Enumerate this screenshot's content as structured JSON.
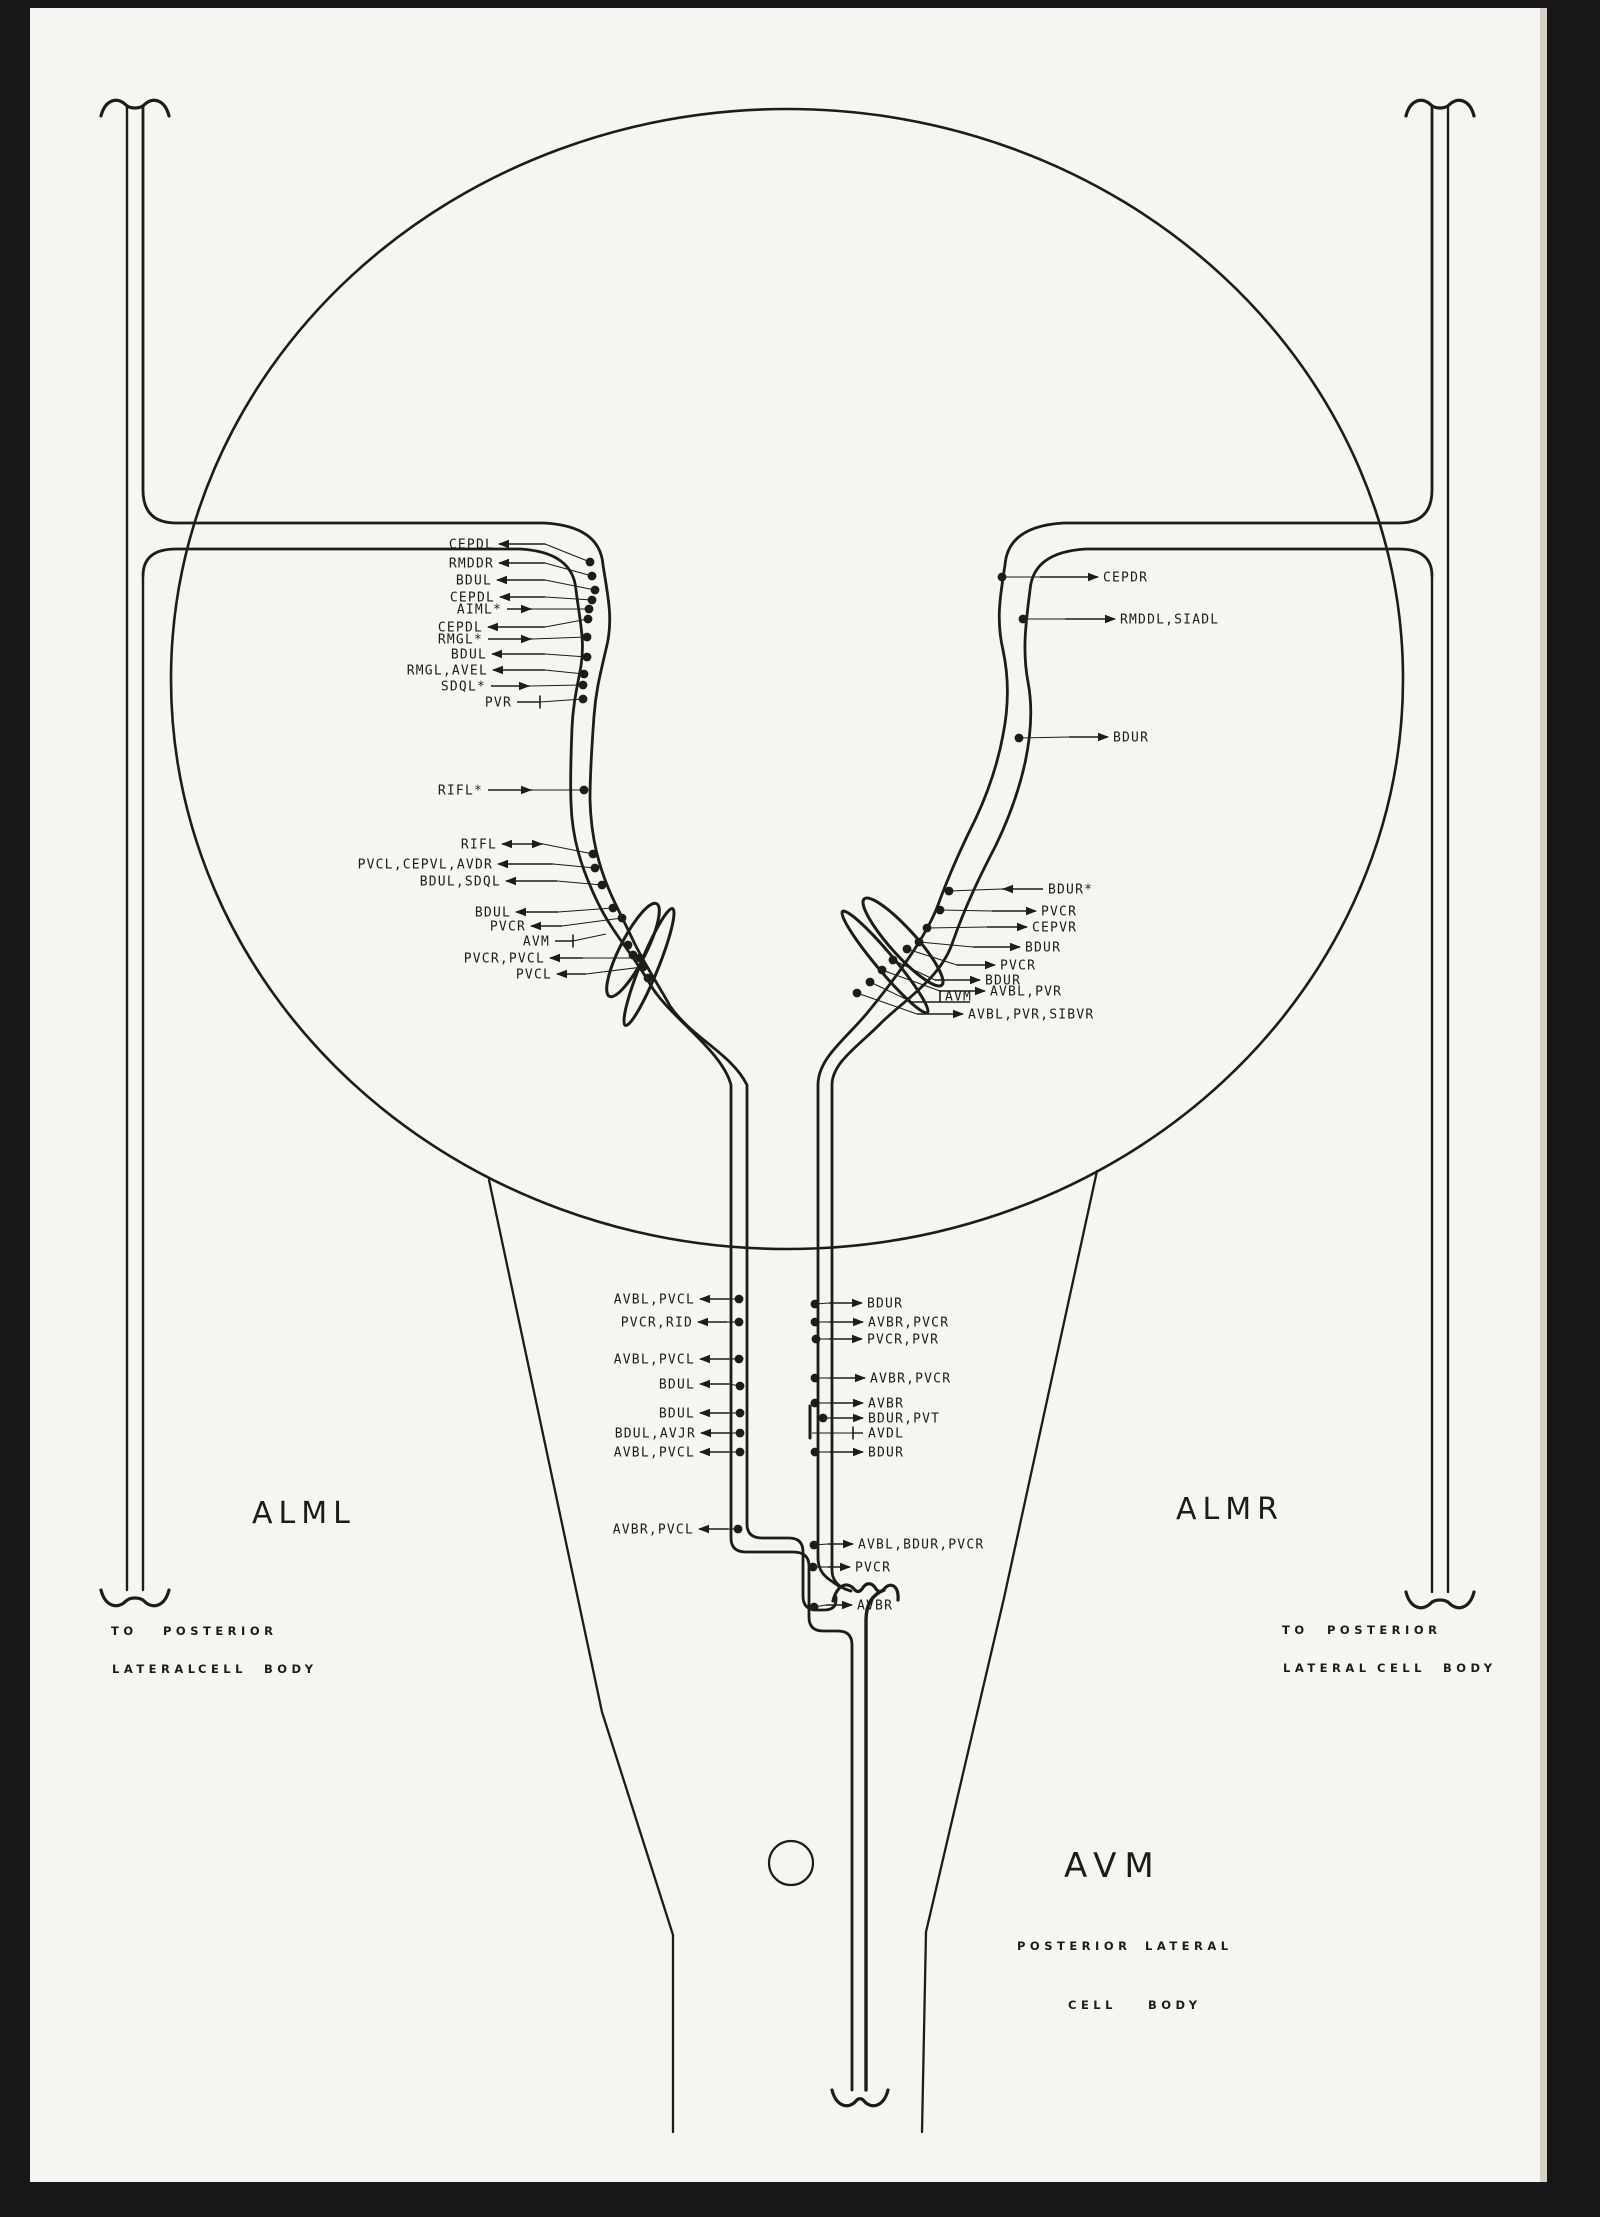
{
  "colors": {
    "ink": "#1e1c19",
    "paper": "#f6f5f1",
    "background": "#17171a",
    "paper_edge": "#d6d0c4"
  },
  "big_labels": {
    "alml": "ALML",
    "almr": "ALMR",
    "avm": "AVM"
  },
  "captions": [
    {
      "t": "TO",
      "x": 111,
      "y": 1635
    },
    {
      "t": "POSTERIOR",
      "x": 163,
      "y": 1635
    },
    {
      "t": "LATERAL",
      "x": 112,
      "y": 1673
    },
    {
      "t": "CELL",
      "x": 198,
      "y": 1673
    },
    {
      "t": "BODY",
      "x": 264,
      "y": 1673
    },
    {
      "t": "TO",
      "x": 1282,
      "y": 1634
    },
    {
      "t": "POSTERIOR",
      "x": 1327,
      "y": 1634
    },
    {
      "t": "LATERAL",
      "x": 1283,
      "y": 1672
    },
    {
      "t": "CELL",
      "x": 1377,
      "y": 1672
    },
    {
      "t": "BODY",
      "x": 1443,
      "y": 1672
    },
    {
      "t": "POSTERIOR",
      "x": 1017,
      "y": 1950
    },
    {
      "t": "LATERAL",
      "x": 1145,
      "y": 1950
    },
    {
      "t": "CELL",
      "x": 1068,
      "y": 2009
    },
    {
      "t": "BODY",
      "x": 1148,
      "y": 2009
    }
  ],
  "annotations": [
    {
      "g": "left-top",
      "t": "CEPDL",
      "s": "L",
      "x": 494,
      "y": 544,
      "hx": 545,
      "h": "T",
      "d": [
        590,
        562
      ]
    },
    {
      "g": "left-top",
      "t": "RMDDR",
      "s": "L",
      "x": 494,
      "y": 563,
      "hx": 545,
      "h": "T",
      "d": [
        592,
        576
      ]
    },
    {
      "g": "left-top",
      "t": "BDUL",
      "s": "L",
      "x": 492,
      "y": 580,
      "hx": 545,
      "h": "T",
      "d": [
        595,
        590
      ]
    },
    {
      "g": "left-top",
      "t": "CEPDL",
      "s": "L",
      "x": 495,
      "y": 597,
      "hx": 545,
      "h": "T",
      "d": [
        592,
        600
      ]
    },
    {
      "g": "left-top",
      "t": "AIML*",
      "s": "L",
      "x": 502,
      "y": 609,
      "hx": 532,
      "h": "F",
      "d": [
        589,
        609
      ]
    },
    {
      "g": "left-top",
      "t": "CEPDL",
      "s": "L",
      "x": 483,
      "y": 627,
      "hx": 545,
      "h": "T",
      "d": [
        588,
        619
      ]
    },
    {
      "g": "left-top",
      "t": "RMGL*",
      "s": "L",
      "x": 483,
      "y": 639,
      "hx": 532,
      "h": "F",
      "d": [
        587,
        637
      ]
    },
    {
      "g": "left-top",
      "t": "BDUL",
      "s": "L",
      "x": 487,
      "y": 654,
      "hx": 545,
      "h": "T",
      "d": [
        587,
        657
      ]
    },
    {
      "g": "left-top",
      "t": "RMGL,AVEL",
      "s": "L",
      "x": 488,
      "y": 670,
      "hx": 545,
      "h": "T",
      "d": [
        584,
        674
      ]
    },
    {
      "g": "left-top",
      "t": "SDQL*",
      "s": "L",
      "x": 486,
      "y": 686,
      "hx": 530,
      "h": "F",
      "d": [
        583,
        685
      ]
    },
    {
      "g": "left-top",
      "t": "PVR",
      "s": "L",
      "x": 512,
      "y": 702,
      "hx": 540,
      "h": "bar",
      "bx": 540,
      "d": [
        583,
        699
      ]
    },
    {
      "g": "left-ring",
      "t": "RIFL*",
      "s": "L",
      "x": 483,
      "y": 790,
      "hx": 532,
      "h": "F",
      "d": [
        584,
        790
      ]
    },
    {
      "g": "left-mid",
      "t": "RIFL",
      "s": "L",
      "x": 497,
      "y": 844,
      "hx": 543,
      "h": "TF",
      "d": [
        593,
        854
      ]
    },
    {
      "g": "left-mid",
      "t": "PVCL,CEPVL,AVDR",
      "s": "L",
      "x": 493,
      "y": 864,
      "hx": 553,
      "h": "T",
      "d": [
        595,
        868
      ]
    },
    {
      "g": "left-mid",
      "t": "BDUL,SDQL",
      "s": "L",
      "x": 501,
      "y": 881,
      "hx": 557,
      "h": "T",
      "d": [
        602,
        885
      ]
    },
    {
      "g": "left-mid",
      "t": "BDUL",
      "s": "L",
      "x": 511,
      "y": 912,
      "hx": 558,
      "h": "T",
      "d": [
        613,
        908
      ]
    },
    {
      "g": "left-mid",
      "t": "PVCR",
      "s": "L",
      "x": 526,
      "y": 926,
      "hx": 562,
      "h": "T",
      "d": [
        622,
        918
      ]
    },
    {
      "g": "left-mid",
      "t": "AVM",
      "s": "L",
      "x": 550,
      "y": 941,
      "hx": 573,
      "h": "bar",
      "bx": 573,
      "d": [
        606,
        934
      ],
      "nd": true
    },
    {
      "g": "left-mid",
      "t": "PVCR,PVCL",
      "s": "L",
      "x": 545,
      "y": 958,
      "hx": 583,
      "h": "T",
      "d": [
        640,
        958
      ]
    },
    {
      "g": "left-mid",
      "t": "PVCL",
      "s": "L",
      "x": 552,
      "y": 974,
      "hx": 586,
      "h": "T",
      "d": [
        643,
        967
      ]
    },
    {
      "g": "right-top",
      "t": "CEPDR",
      "s": "R",
      "x": 1103,
      "y": 577,
      "hx": 1040,
      "h": "T",
      "d": [
        1002,
        577
      ]
    },
    {
      "g": "right-top",
      "t": "RMDDL,SIADL",
      "s": "R",
      "x": 1120,
      "y": 619,
      "hx": 1065,
      "h": "T",
      "d": [
        1023,
        619
      ]
    },
    {
      "g": "right-top",
      "t": "BDUR",
      "s": "R",
      "x": 1113,
      "y": 737,
      "hx": 1069,
      "h": "T",
      "d": [
        1019,
        738
      ]
    },
    {
      "g": "right-mid",
      "t": "BDUR*",
      "s": "R",
      "x": 1048,
      "y": 889,
      "hx": 1002,
      "h": "F",
      "d": [
        949,
        891
      ]
    },
    {
      "g": "right-mid",
      "t": "PVCR",
      "s": "R",
      "x": 1041,
      "y": 911,
      "hx": 992,
      "h": "T",
      "d": [
        940,
        910
      ]
    },
    {
      "g": "right-mid",
      "t": "CEPVR",
      "s": "R",
      "x": 1032,
      "y": 927,
      "hx": 987,
      "h": "T",
      "d": [
        927,
        928
      ]
    },
    {
      "g": "right-mid",
      "t": "BDUR",
      "s": "R",
      "x": 1025,
      "y": 947,
      "hx": 973,
      "h": "T",
      "d": [
        919,
        942
      ]
    },
    {
      "g": "right-mid",
      "t": "PVCR",
      "s": "R",
      "x": 1000,
      "y": 965,
      "hx": 957,
      "h": "T",
      "d": [
        907,
        949
      ]
    },
    {
      "g": "right-mid",
      "t": "BDUR",
      "s": "R",
      "x": 985,
      "y": 980,
      "hx": 935,
      "h": "T",
      "d": [
        893,
        960
      ]
    },
    {
      "g": "right-mid",
      "t": "AVBL,PVR",
      "s": "R",
      "x": 990,
      "y": 991,
      "hx": 940,
      "h": "T",
      "d": [
        882,
        970
      ]
    },
    {
      "g": "right-mid",
      "t": "AVM",
      "s": "R",
      "x": 945,
      "y": 996,
      "hx": 912,
      "h": "barU",
      "bx": 940,
      "d": [
        870,
        982
      ]
    },
    {
      "g": "right-mid",
      "t": "AVBL,PVR,SIBVR",
      "s": "R",
      "x": 968,
      "y": 1014,
      "hx": 917,
      "h": "T",
      "d": [
        857,
        993
      ]
    },
    {
      "g": "center-left",
      "t": "AVBL,PVCL",
      "s": "L",
      "x": 695,
      "y": 1299,
      "hx": 729,
      "h": "T",
      "d": [
        739,
        1299
      ]
    },
    {
      "g": "center-left",
      "t": "PVCR,RID",
      "s": "L",
      "x": 693,
      "y": 1322,
      "hx": 727,
      "h": "T",
      "d": [
        739,
        1322
      ]
    },
    {
      "g": "center-left",
      "t": "AVBL,PVCL",
      "s": "L",
      "x": 695,
      "y": 1359,
      "hx": 729,
      "h": "T",
      "d": [
        739,
        1359
      ]
    },
    {
      "g": "center-left",
      "t": "BDUL",
      "s": "L",
      "x": 695,
      "y": 1384,
      "hx": 729,
      "h": "T",
      "d": [
        740,
        1386
      ]
    },
    {
      "g": "center-left",
      "t": "BDUL",
      "s": "L",
      "x": 695,
      "y": 1413,
      "hx": 729,
      "h": "T",
      "d": [
        740,
        1413
      ]
    },
    {
      "g": "center-left",
      "t": "BDUL,AVJR",
      "s": "L",
      "x": 696,
      "y": 1433,
      "hx": 730,
      "h": "T",
      "d": [
        740,
        1433
      ]
    },
    {
      "g": "center-left",
      "t": "AVBL,PVCL",
      "s": "L",
      "x": 695,
      "y": 1452,
      "hx": 729,
      "h": "T",
      "d": [
        740,
        1452
      ]
    },
    {
      "g": "center-left",
      "t": "AVBR,PVCL",
      "s": "L",
      "x": 694,
      "y": 1529,
      "hx": 728,
      "h": "T",
      "d": [
        738,
        1529
      ]
    },
    {
      "g": "center-right",
      "t": "BDUR",
      "s": "R",
      "x": 867,
      "y": 1303,
      "hx": 829,
      "h": "T",
      "d": [
        815,
        1304
      ]
    },
    {
      "g": "center-right",
      "t": "AVBR,PVCR",
      "s": "R",
      "x": 868,
      "y": 1322,
      "hx": 829,
      "h": "T",
      "d": [
        815,
        1322
      ]
    },
    {
      "g": "center-right",
      "t": "PVCR,PVR",
      "s": "R",
      "x": 867,
      "y": 1339,
      "hx": 829,
      "h": "T",
      "d": [
        816,
        1339
      ]
    },
    {
      "g": "center-right",
      "t": "AVBR,PVCR",
      "s": "R",
      "x": 870,
      "y": 1378,
      "hx": 830,
      "h": "T",
      "d": [
        815,
        1378
      ]
    },
    {
      "g": "center-right",
      "t": "AVBR",
      "s": "R",
      "x": 868,
      "y": 1403,
      "hx": 830,
      "h": "T",
      "d": [
        815,
        1403
      ]
    },
    {
      "g": "center-right",
      "t": "BDUR,PVT",
      "s": "R",
      "x": 868,
      "y": 1418,
      "hx": 832,
      "h": "T",
      "d": [
        823,
        1418
      ]
    },
    {
      "g": "center-right",
      "t": "AVDL",
      "s": "R",
      "x": 868,
      "y": 1433,
      "hx": 830,
      "h": "bar",
      "bx": 853,
      "d": [
        812,
        1433
      ],
      "nd": true
    },
    {
      "g": "center-right",
      "t": "BDUR",
      "s": "R",
      "x": 868,
      "y": 1452,
      "hx": 830,
      "h": "T",
      "d": [
        815,
        1452
      ]
    },
    {
      "g": "bottom-center",
      "t": "AVBL,BDUR,PVCR",
      "s": "R",
      "x": 858,
      "y": 1544,
      "hx": 828,
      "h": "T",
      "d": [
        814,
        1545
      ]
    },
    {
      "g": "bottom-center",
      "t": "PVCR",
      "s": "R",
      "x": 855,
      "y": 1567,
      "hx": 828,
      "h": "T",
      "d": [
        813,
        1567
      ]
    },
    {
      "g": "bottom-center",
      "t": "AVBR",
      "s": "R",
      "x": 857,
      "y": 1605,
      "hx": 826,
      "h": "T",
      "d": [
        814,
        1607
      ]
    }
  ],
  "extra_dots": [
    [
      628,
      945
    ],
    [
      633,
      955
    ],
    [
      648,
      978
    ]
  ]
}
